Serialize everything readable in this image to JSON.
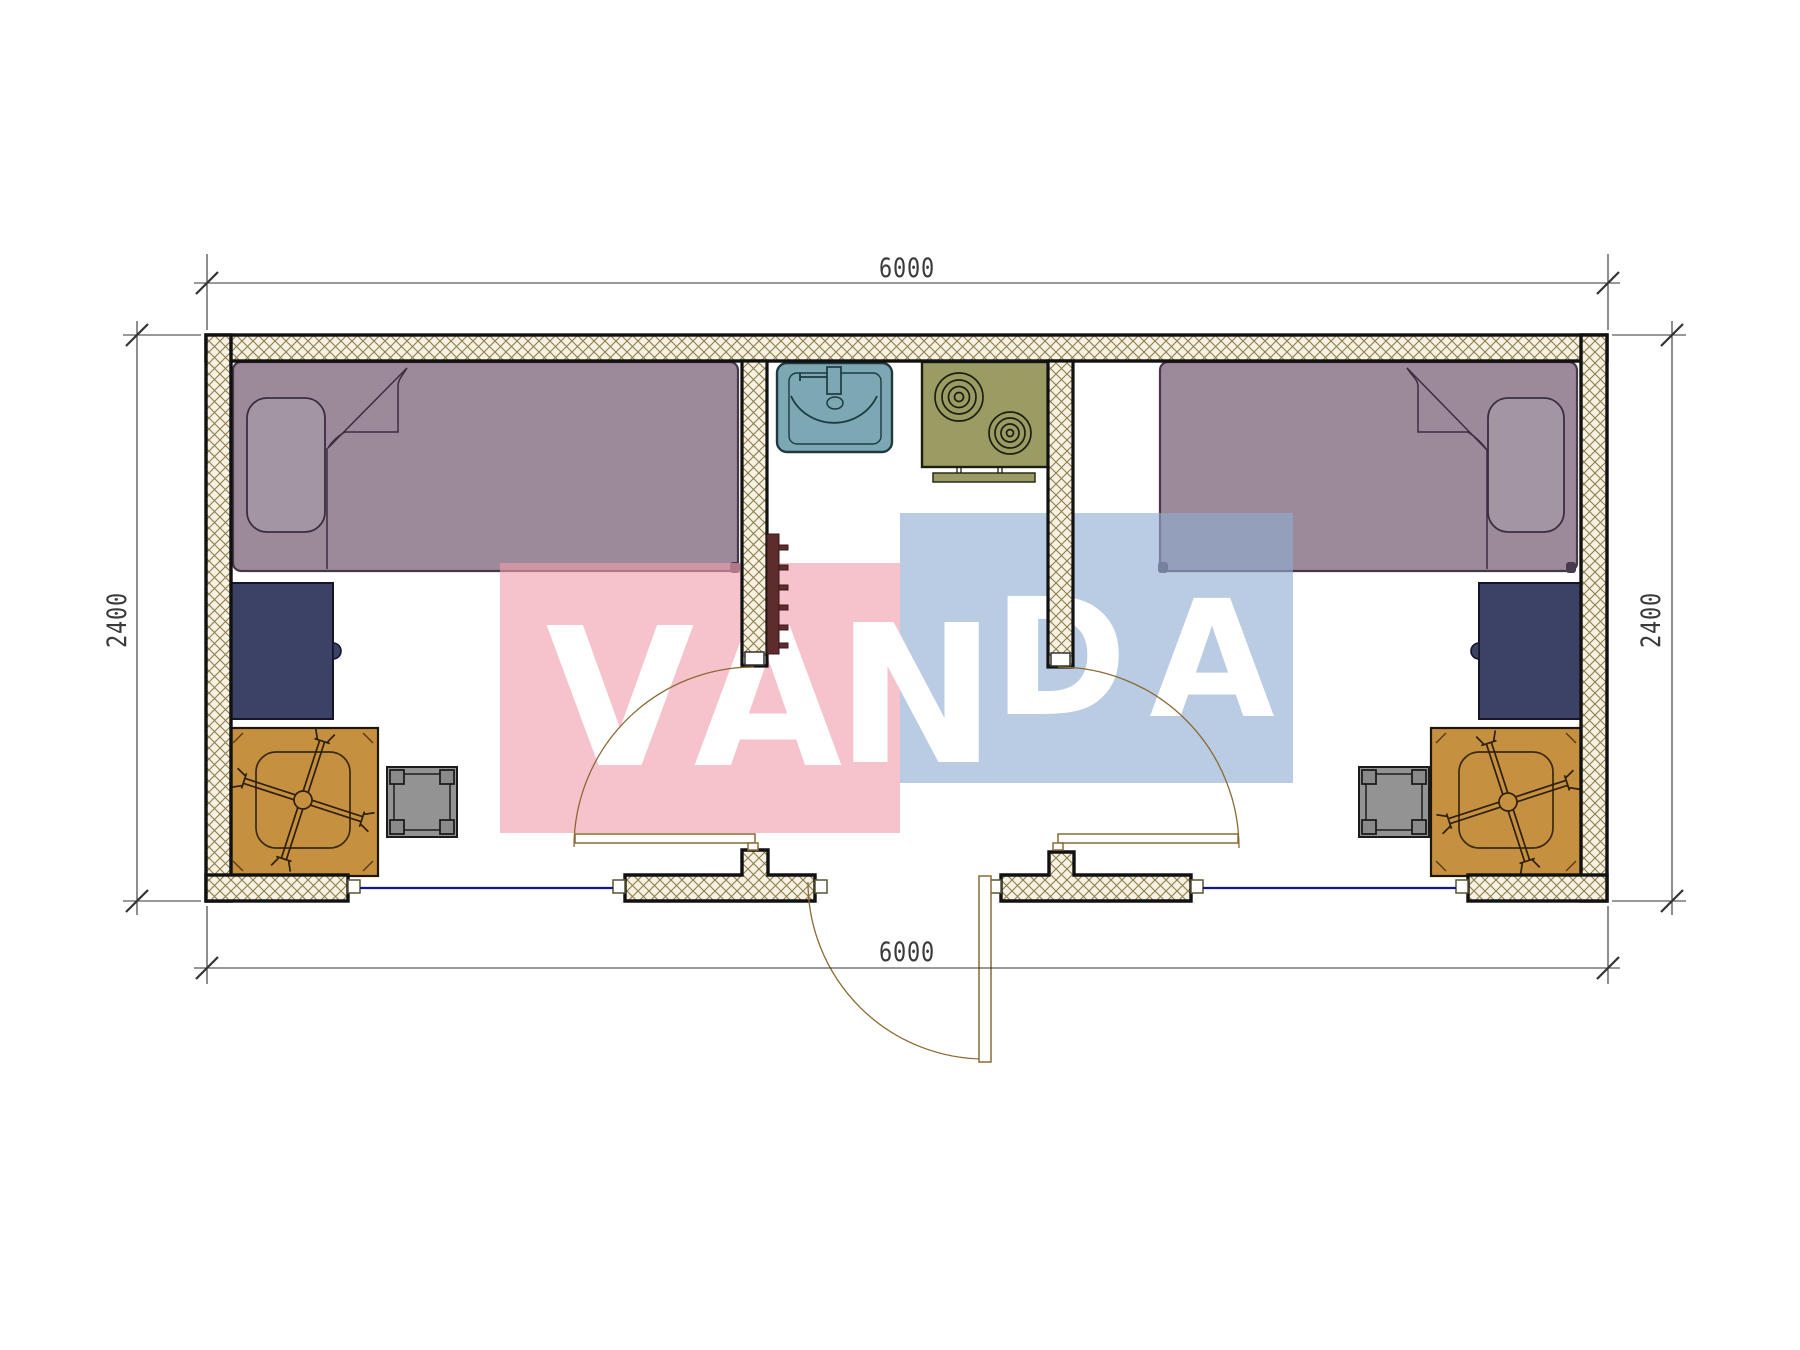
{
  "drawing": {
    "type": "container-house floor plan, top view",
    "dimensions": {
      "top_width": "6000",
      "bottom_width": "6000",
      "left_height": "2400",
      "right_height": "2400"
    },
    "watermark": {
      "letters": [
        "V",
        "A",
        "N",
        "D",
        "A"
      ],
      "pink_block": "#f5c0ca",
      "blue_block": "#bccde4",
      "letter_color": "#ffffff"
    },
    "colors": {
      "wall_hatch_line": "#8d7c4e",
      "wall_hatch_bg": "#f6f1e1",
      "wall_outline": "#111111",
      "bed": "#9c8a9a",
      "pillow": "#a495a3",
      "desk": "#3c4266",
      "chair": "#c59040",
      "stool": "#939393",
      "sink": "#7ba8b3",
      "stove": "#9b9b64",
      "window_glazing": "#14148c",
      "door": "#8a6a35",
      "radiator": "#5d2c2c",
      "dimension_lines": "#333333"
    }
  }
}
